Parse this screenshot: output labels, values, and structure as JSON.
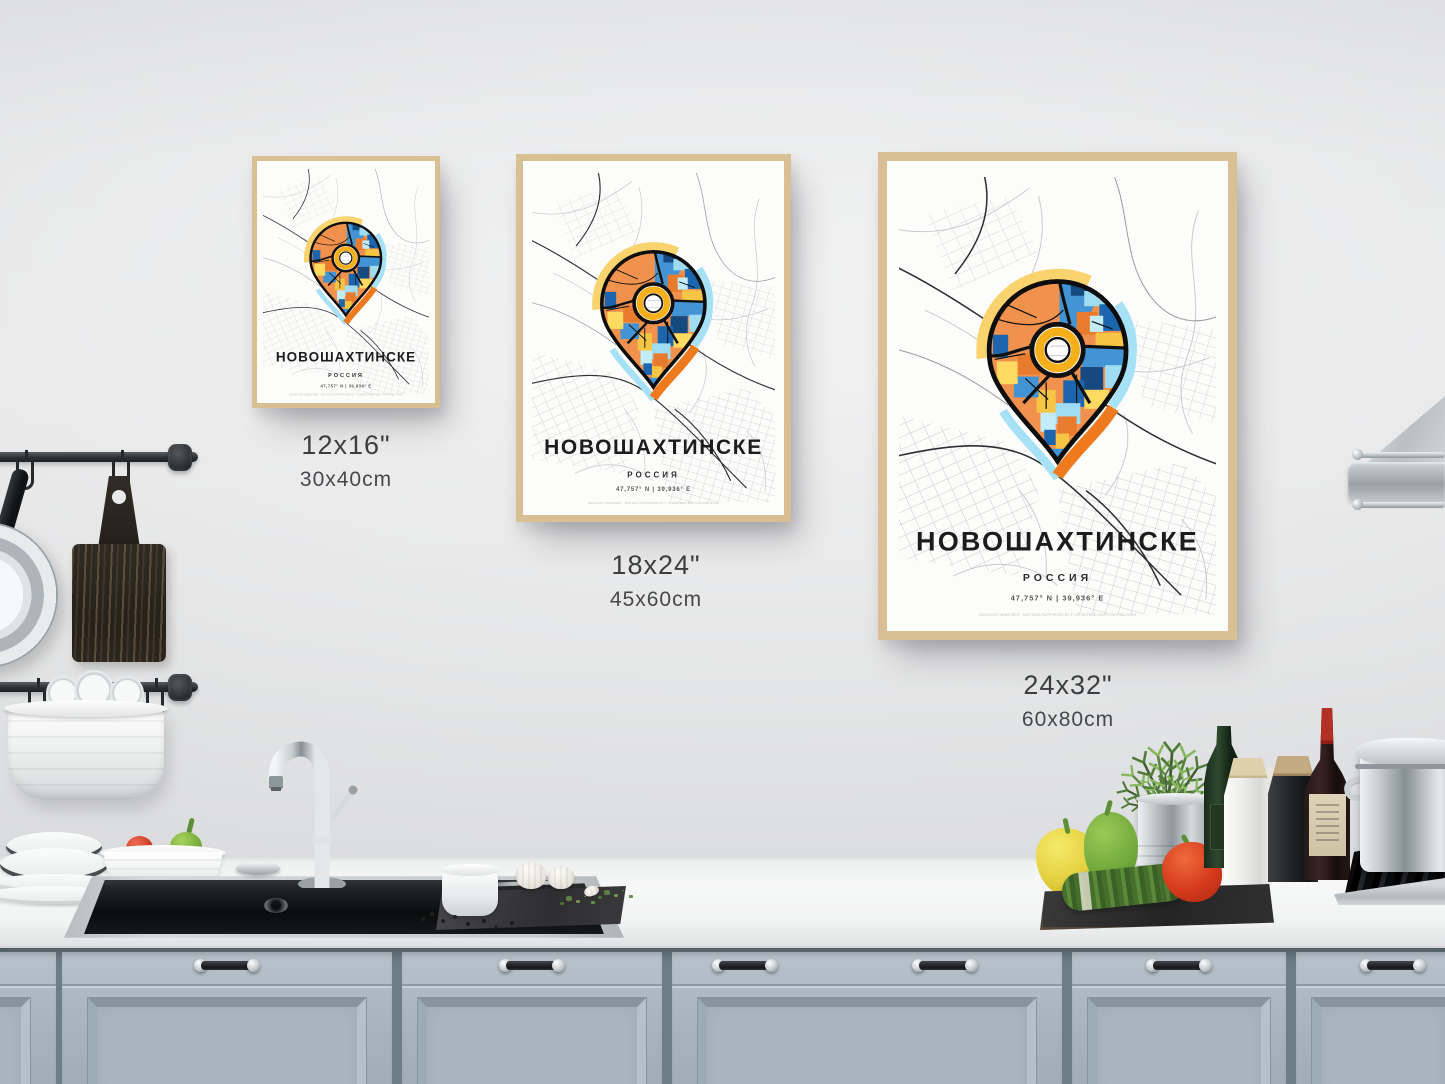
{
  "posters": {
    "title": "НОВОШАХТИНСКЕ",
    "subtitle": "РОССИЯ",
    "coordinates": "47,757° N | 39,936° E",
    "credit": "DESIGN BY HEBSTREIT · MAP DATA SUPPORTED BY © OPENSTREETMAP CONTRIBUTORS"
  },
  "sizes": [
    {
      "inches": "12x16\"",
      "cm": "30x40cm"
    },
    {
      "inches": "18x24\"",
      "cm": "45x60cm"
    },
    {
      "inches": "24x32\"",
      "cm": "60x80cm"
    }
  ],
  "colors": {
    "cabinet-gap": "#6e7d88",
    "frame-wood": "#d8bf94",
    "poster-bg": "#fcfcfa",
    "map-road-light": "#c7c9cb",
    "map-road-mid": "#9b9fa3",
    "map-road-dark": "#2c2f33",
    "pin-orange": "#F0924E",
    "pin-orange-deep": "#E87B2E",
    "pin-blue": "#1B66AE",
    "pin-blue-light": "#4394D4",
    "pin-sky": "#9FDCF2",
    "pin-sky-pale": "#C3ECF9",
    "pin-yellow": "#F6C544",
    "pin-yellow-light": "#FFDA60",
    "pin-navy": "#15497F",
    "pin-ring-yellow": "#F4AF1B",
    "halo-yellow": "#F8D36E",
    "halo-cyan": "#A6E1F6",
    "halo-orange": "#EF7A1D",
    "text-dark": "#1c1c1e",
    "text-label": "#3b3d3f"
  }
}
